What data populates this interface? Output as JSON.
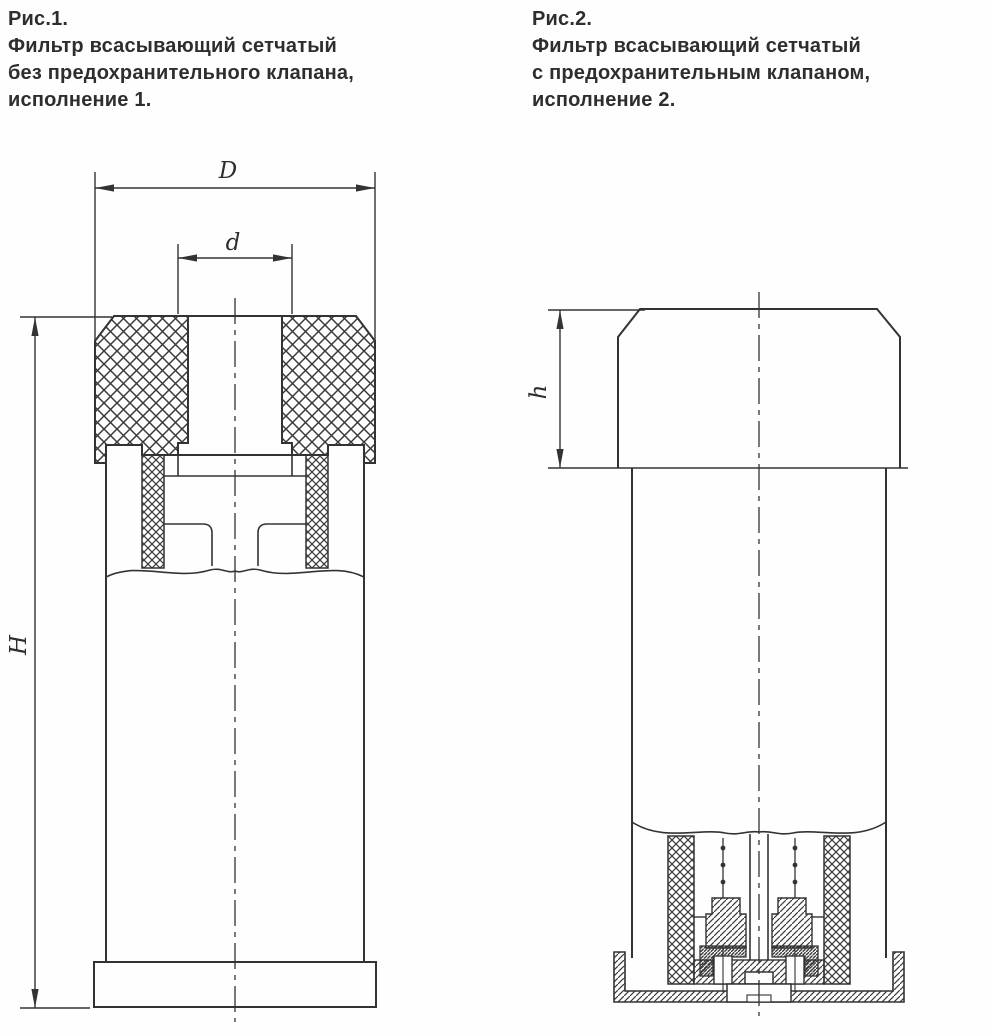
{
  "page": {
    "background": "#fefefe",
    "line_color": "#333333"
  },
  "figure1": {
    "label": "Рис.1.",
    "caption": [
      "Фильтр всасывающий сетчатый",
      "без предохранительного клапана,",
      "исполнение 1."
    ],
    "dimensions": {
      "outer_diameter": "D",
      "bore_diameter": "d",
      "total_height": "H"
    }
  },
  "figure2": {
    "label": "Рис.2.",
    "caption": [
      "Фильтр всасывающий сетчатый",
      "с предохранительным клапаном,",
      "исполнение 2."
    ],
    "dimensions": {
      "cap_height": "h"
    }
  }
}
